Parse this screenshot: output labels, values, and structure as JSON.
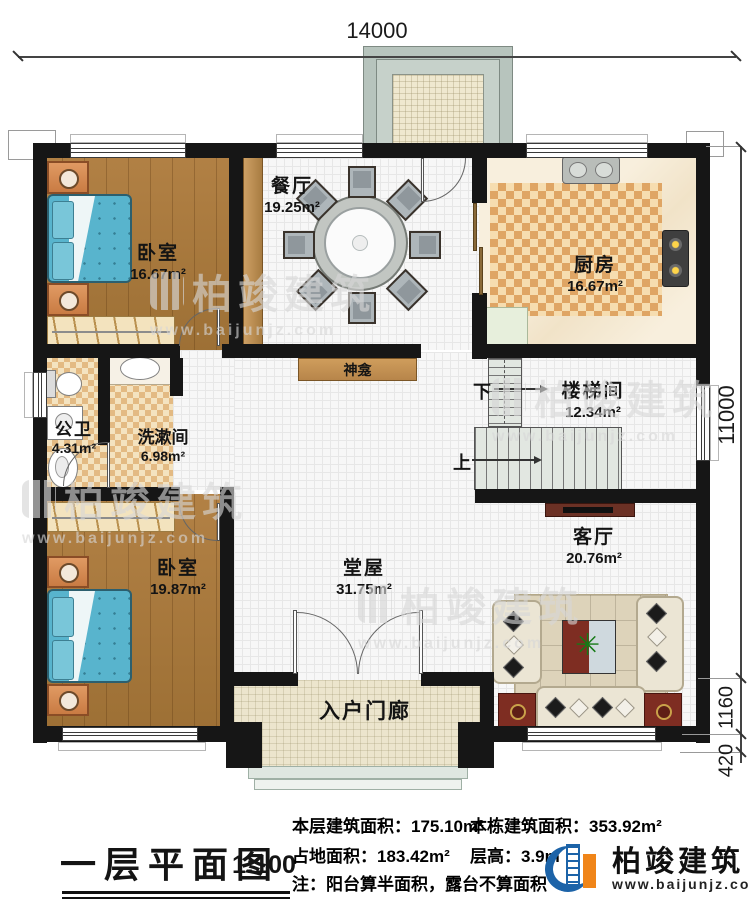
{
  "plan": {
    "title": "一层平面图",
    "scale": "1:100",
    "dim_top": "14000",
    "dim_right_main": "11000",
    "dim_right_bay": "1160",
    "dim_right_steps": "420"
  },
  "rooms": {
    "bedroom1": {
      "name": "卧室",
      "area": "16.67m²"
    },
    "dining": {
      "name": "餐厅",
      "area": "19.25m²"
    },
    "kitchen": {
      "name": "厨房",
      "area": "16.67m²"
    },
    "bathroom": {
      "name": "公卫",
      "area": "4.31m²"
    },
    "washroom": {
      "name": "洗漱间",
      "area": "6.98m²"
    },
    "stairwell": {
      "name": "楼梯间",
      "area": "12.34m²"
    },
    "bedroom2": {
      "name": "卧室",
      "area": "19.87m²"
    },
    "hall": {
      "name": "堂屋",
      "area": "31.75m²"
    },
    "living": {
      "name": "客厅",
      "area": "20.76m²"
    },
    "entry_porch": {
      "name": "入户门廊"
    },
    "shrine": {
      "name": "神龛"
    }
  },
  "stairs": {
    "up": "上",
    "down": "下"
  },
  "title_block": {
    "floor_area_label": "本层建筑面积：",
    "floor_area_value": "175.10m²",
    "total_area_label": "本栋建筑面积：",
    "total_area_value": "353.92m²",
    "land_area_label": "占地面积：",
    "land_area_value": "183.42m²",
    "height_label": "层高：",
    "height_value": "3.9m",
    "note": "注：阳台算半面积，露台不算面积"
  },
  "brand": {
    "name": "柏竣建筑",
    "url": "www.baijunjz.com"
  },
  "watermark": {
    "name": "柏竣建筑",
    "url": "www.baijunjz.com"
  },
  "colors": {
    "wall": "#161616",
    "brand_blue": "#1c63a8",
    "brand_orange": "#f08519",
    "bed_blue": "#58b4cd",
    "wood": "#a97a3f"
  }
}
